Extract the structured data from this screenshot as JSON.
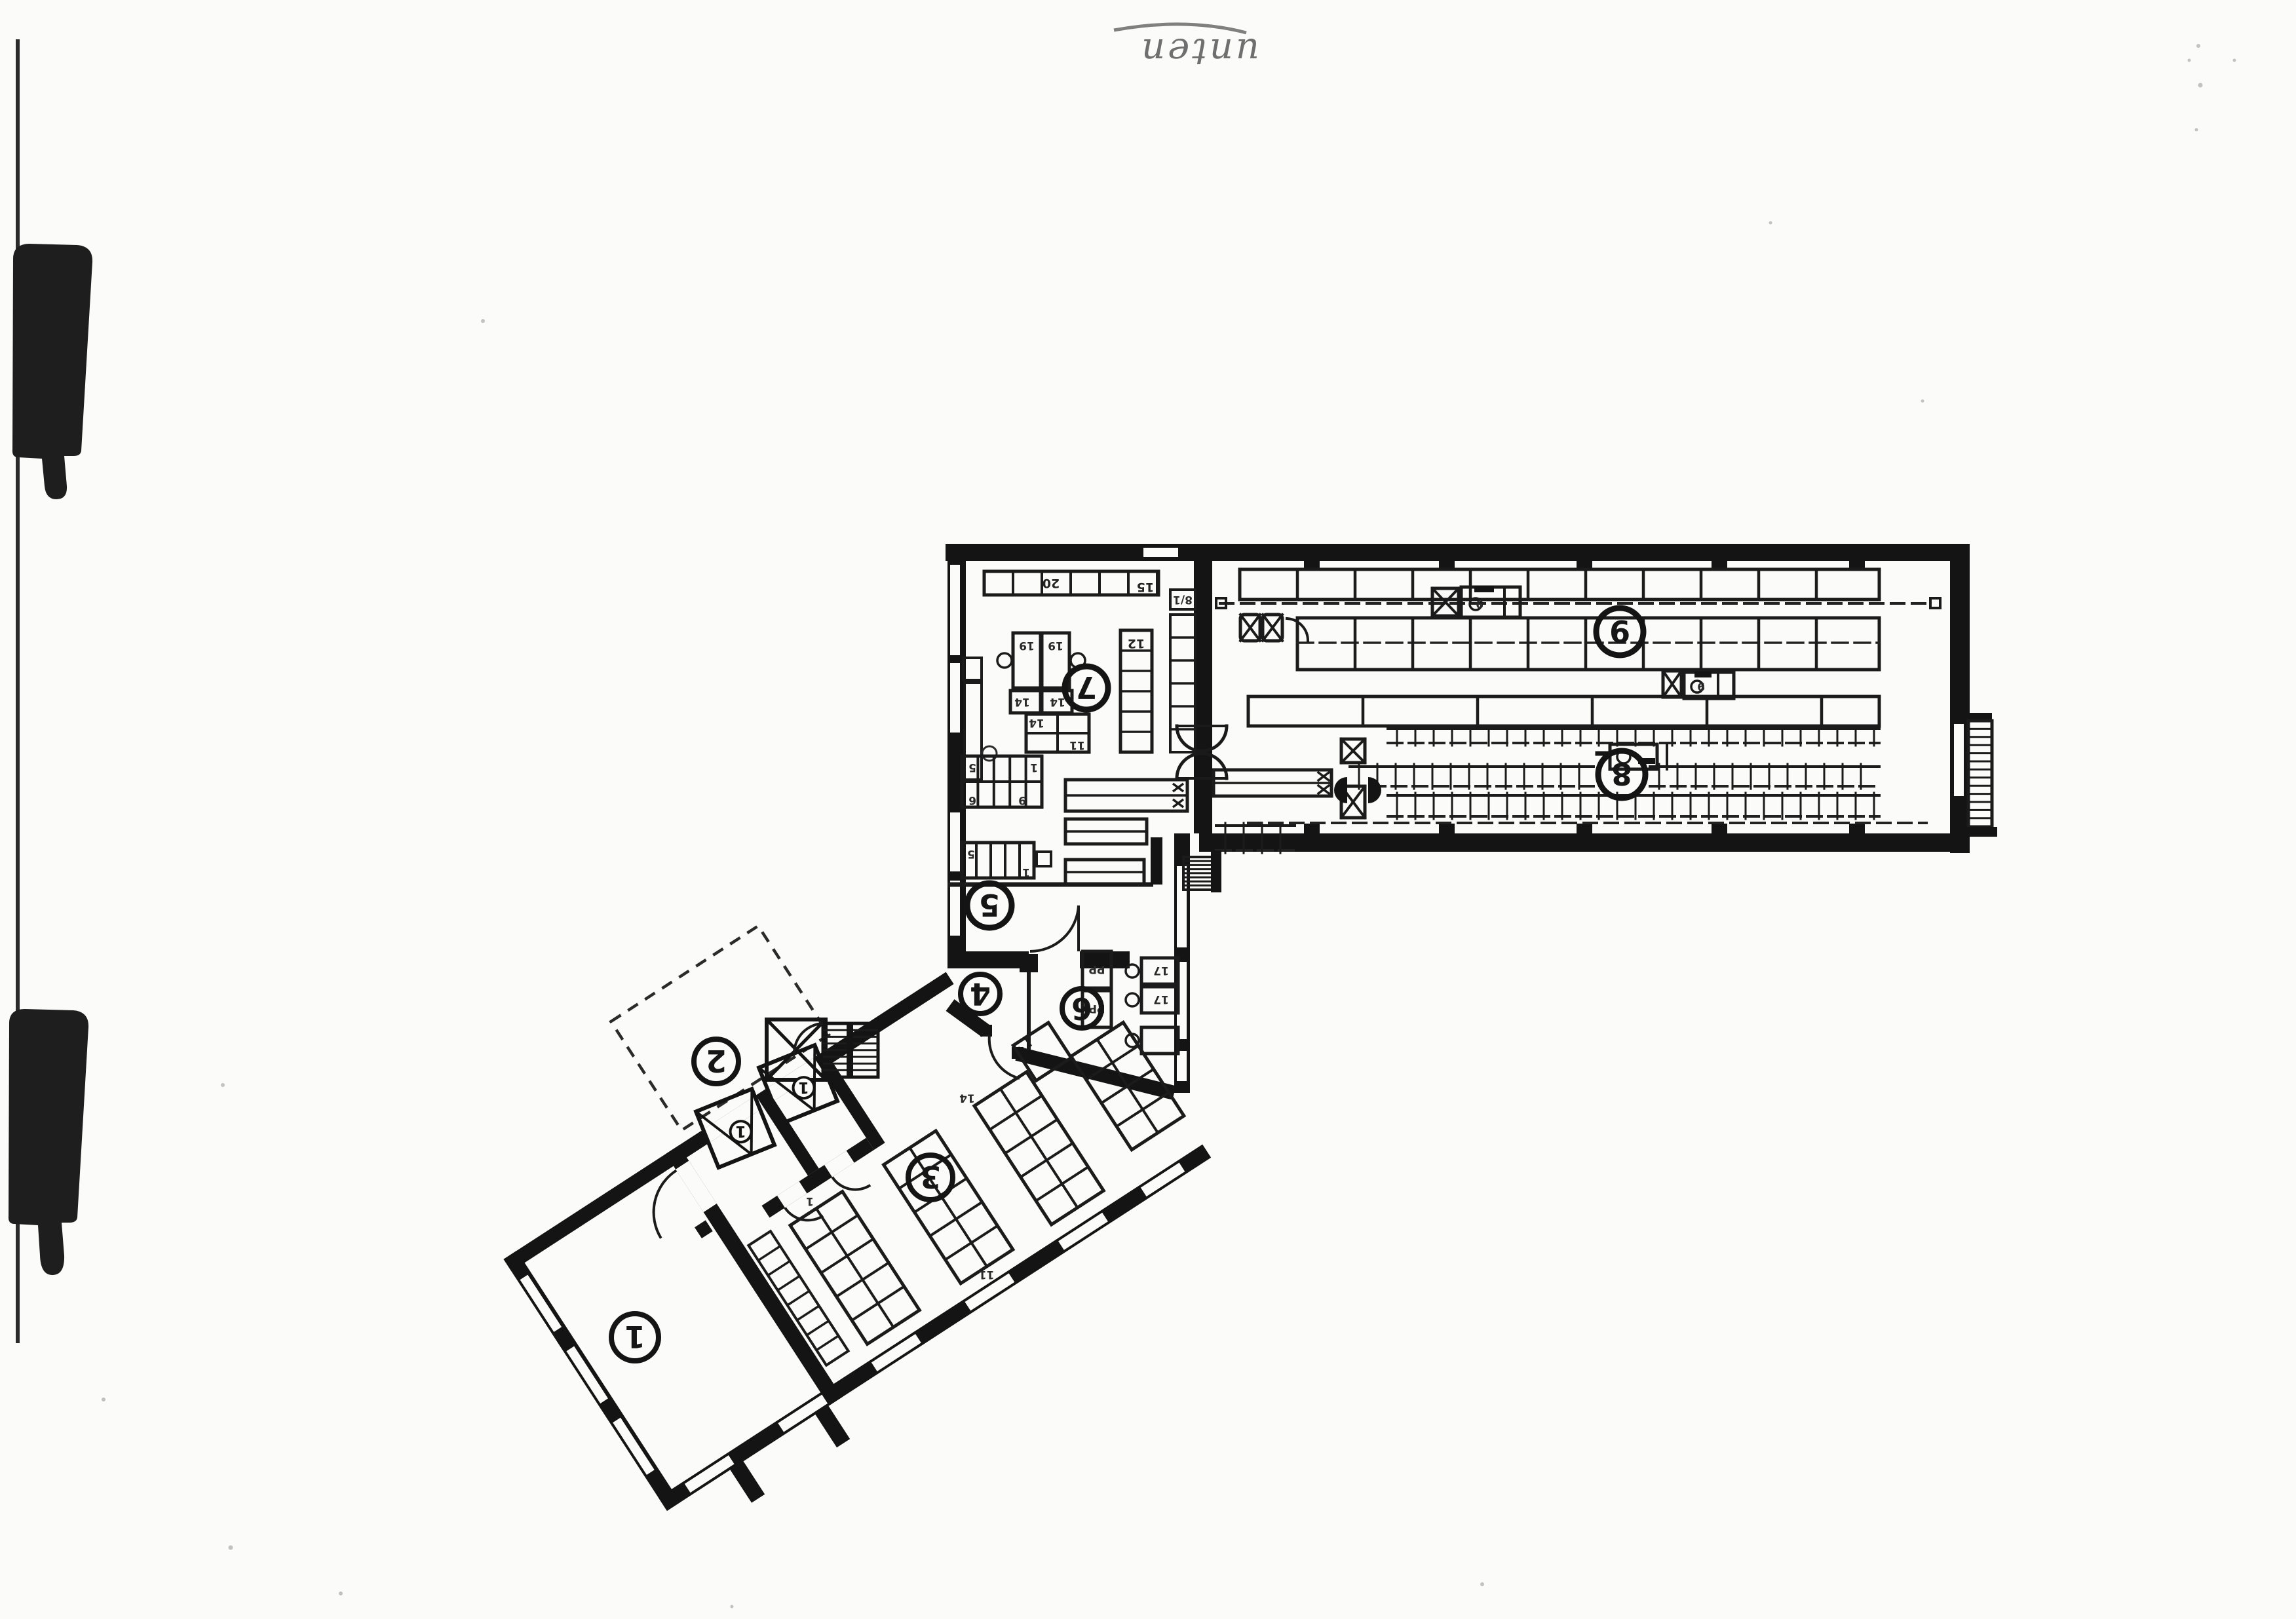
{
  "page": {
    "paper_color": "#fbfbf9",
    "ink_color": "#1a1a1a"
  },
  "handwriting": {
    "note": "unten"
  },
  "floor_plan": {
    "room_labels": {
      "r1": "1",
      "r2": "2",
      "r3": "3",
      "r4": "4",
      "r5": "5",
      "r6": "6",
      "r7": "7",
      "r8": "8",
      "r9": "9"
    },
    "elevator_labels": {
      "car_a": "1",
      "car_b": "1"
    },
    "furniture_tags": {
      "shelf_20": "20",
      "shelf_15": "15",
      "shelf_8_1": "8/1",
      "shelf_12": "12",
      "desk_19a": "19",
      "desk_19b": "19",
      "return_14a": "14",
      "return_14b": "14",
      "table_14": "14",
      "table_11": "11",
      "blockA_5": "5",
      "blockA_6": "6",
      "blockA_1": "1",
      "blockA_9": "9",
      "blockB_5": "5",
      "blockB_1": "1",
      "pp_a": "PP",
      "pp_b": "PP",
      "desk_17a": "17",
      "desk_17b": "17",
      "hall_unit_9a": "9",
      "hall_unit_9b": "9",
      "grid_11": "11",
      "grid_14": "14",
      "grid_1": "1"
    }
  }
}
